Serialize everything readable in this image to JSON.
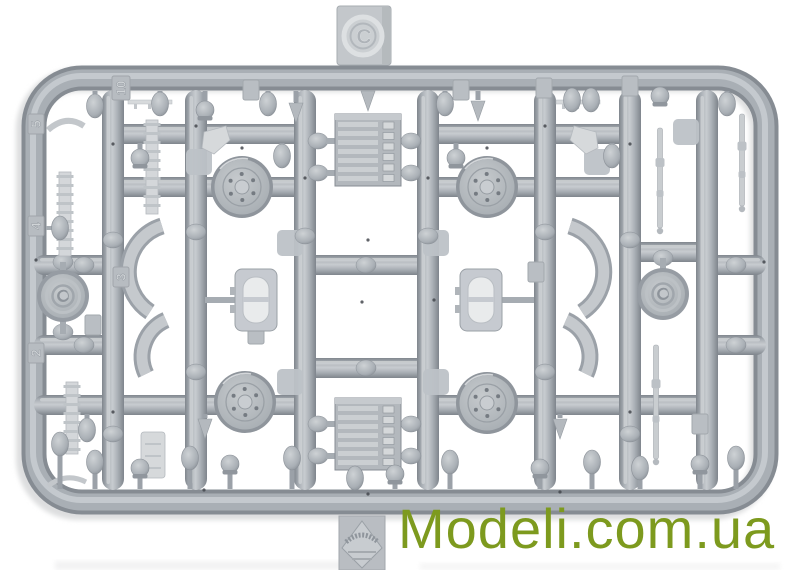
{
  "photo": {
    "subject": "Gray injection-molded plastic model kit sprue photographed on a white background",
    "background_color": "#ffffff",
    "plastic_color": "#a8aeb4"
  },
  "sprue": {
    "gate_letter": "C",
    "part_number_tabs": {
      "tab_10": "10",
      "tab_5": "5",
      "tab_4": "4",
      "tab_3": "3",
      "tab_2": "2"
    },
    "visible_parts": [
      "road wheels",
      "spoked idler wheels",
      "ribbed engine blocks",
      "oval hatches",
      "curved fender sections",
      "gun barrels and rods",
      "track sections",
      "small fittings and bulbs"
    ]
  },
  "watermark": {
    "text": "Modeli.com.ua",
    "color": "#7d9a1e"
  }
}
